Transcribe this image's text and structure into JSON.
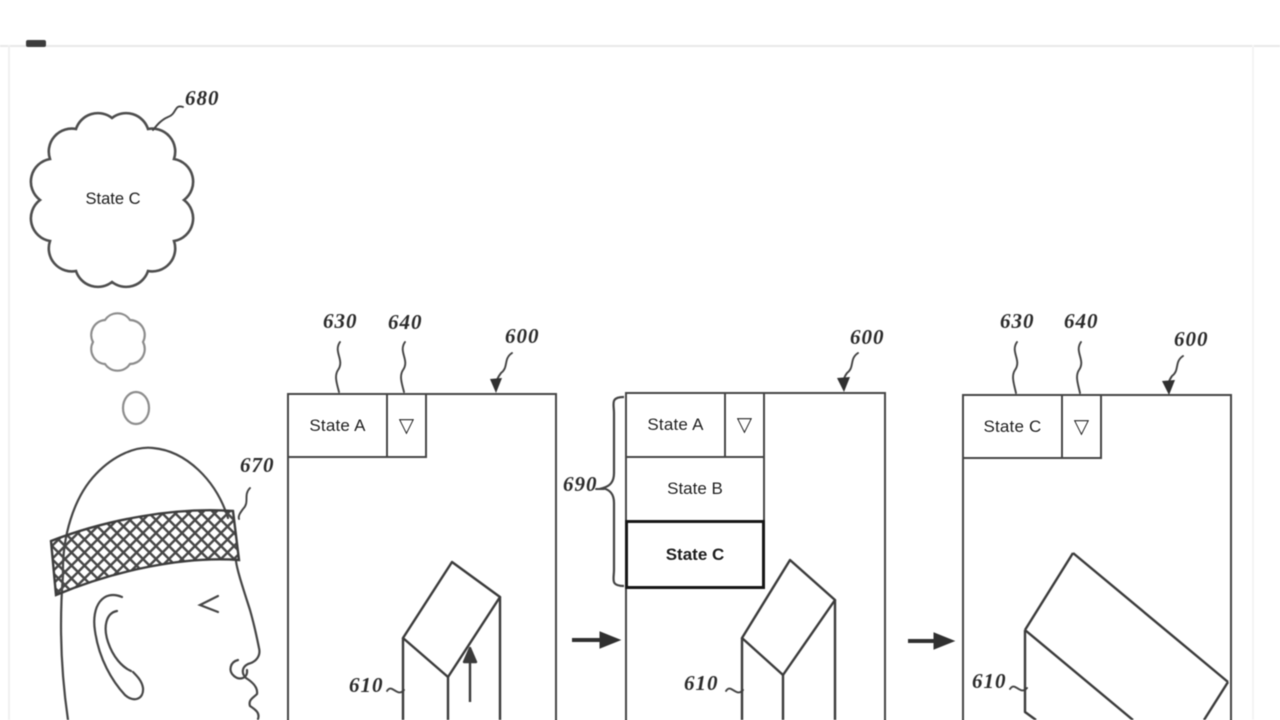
{
  "bubble": {
    "text": "State C",
    "ref": "680"
  },
  "headband": {
    "ref": "670"
  },
  "panel1": {
    "window_ref": "600",
    "field_ref": "630",
    "button_ref": "640",
    "object_ref": "610",
    "selected": "State A",
    "dropdown_glyph": "▽"
  },
  "panel2": {
    "window_ref": "600",
    "list_ref": "690",
    "object_ref": "610",
    "selected": "State A",
    "dropdown_glyph": "▽",
    "options": [
      "State B",
      "State C"
    ]
  },
  "panel3": {
    "window_ref": "600",
    "field_ref": "630",
    "button_ref": "640",
    "object_ref": "610",
    "selected": "State C",
    "dropdown_glyph": "▽"
  }
}
